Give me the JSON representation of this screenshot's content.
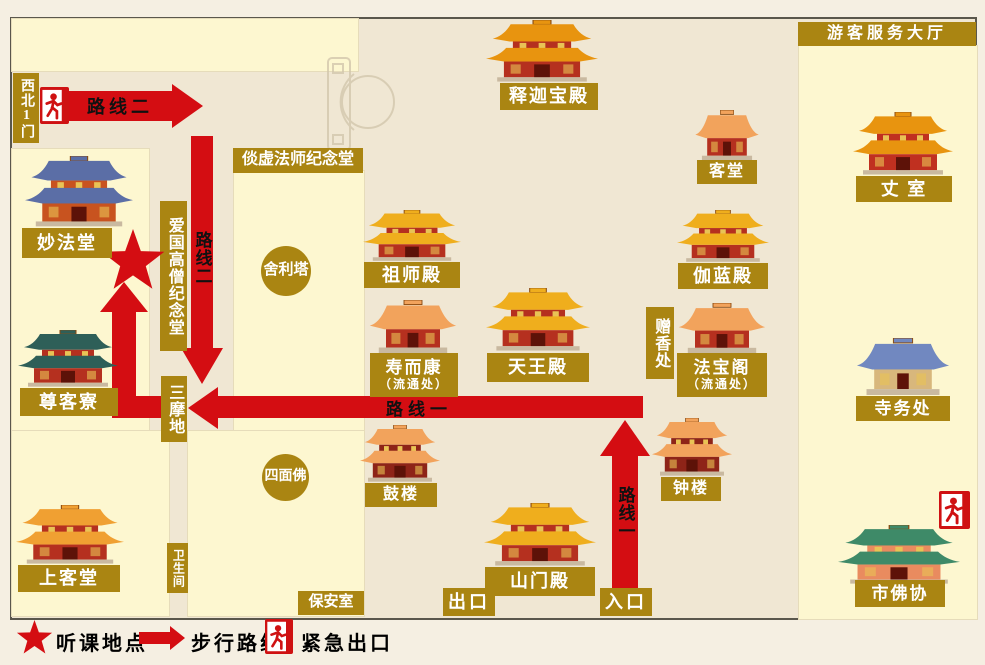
{
  "banner": {
    "visitor_hall": "游客服务大厅"
  },
  "routes": {
    "route1": "路线一",
    "route2": "路线二"
  },
  "areas": {
    "northwest_gate": "西北1门",
    "tanxu_memorial": "倓虚法师纪念堂",
    "patriotic_monk_memorial": "爱国高僧纪念堂",
    "samadhi": "三摩地",
    "sarira_pagoda": "舍利塔",
    "four_faced_buddha": "四面佛",
    "incense_offering": "赠香处",
    "restroom": "卫生间",
    "security_room": "保安室",
    "exit": "出口",
    "entrance": "入口"
  },
  "buildings": [
    {
      "id": "shijiabaodian",
      "label": "释迦宝殿",
      "roof": "#e8940f",
      "body": "#b5301f",
      "tiers": 2
    },
    {
      "id": "ketang",
      "label": "客堂",
      "roof": "#f2a35c",
      "body": "#b5301f",
      "tiers": 1
    },
    {
      "id": "zhangshi",
      "label": "丈 室",
      "roof": "#e8940f",
      "body": "#c03020",
      "tiers": 2
    },
    {
      "id": "miaofatang",
      "label": "妙法堂",
      "roof": "#5b6ea6",
      "body": "#c8531f",
      "tiers": 2
    },
    {
      "id": "zushidian",
      "label": "祖师殿",
      "roof": "#efae1d",
      "body": "#b5301f",
      "tiers": 2
    },
    {
      "id": "qielandian",
      "label": "伽蓝殿",
      "roof": "#efae1d",
      "body": "#b5301f",
      "tiers": 2
    },
    {
      "id": "shouerkang",
      "label": "寿而康",
      "sublabel": "（流通处）",
      "roof": "#f2a35c",
      "body": "#b5301f",
      "tiers": 1
    },
    {
      "id": "tianwangdian",
      "label": "天王殿",
      "roof": "#efae1d",
      "body": "#b5301f",
      "tiers": 2
    },
    {
      "id": "fabaoge",
      "label": "法宝阁",
      "sublabel": "（流通处）",
      "roof": "#f2a35c",
      "body": "#b5301f",
      "tiers": 1
    },
    {
      "id": "siwuchu",
      "label": "寺务处",
      "roof": "#7188c0",
      "body": "#d8b77c",
      "tiers": 1
    },
    {
      "id": "zunkeliao",
      "label": "尊客寮",
      "roof": "#2e5f58",
      "body": "#b5301f",
      "tiers": 2
    },
    {
      "id": "gulou",
      "label": "鼓楼",
      "roof": "#f2a35c",
      "body": "#8e2418",
      "tiers": 2
    },
    {
      "id": "zhonglou",
      "label": "钟楼",
      "roof": "#f2a35c",
      "body": "#8e2418",
      "tiers": 2
    },
    {
      "id": "shanmendian",
      "label": "山门殿",
      "roof": "#efae1d",
      "body": "#b5301f",
      "tiers": 2
    },
    {
      "id": "shangketang",
      "label": "上客堂",
      "roof": "#f0a032",
      "body": "#b5301f",
      "tiers": 2
    },
    {
      "id": "shifoxie",
      "label": "市佛协",
      "roof": "#3e8a68",
      "body": "#e98b5f",
      "tiers": 2
    }
  ],
  "legend": {
    "items": [
      {
        "icon": "star-icon",
        "label": "听课地点"
      },
      {
        "icon": "walk-arrow-icon",
        "label": "步行路线"
      },
      {
        "icon": "emergency-exit-icon",
        "label": "紧急出口"
      }
    ]
  },
  "colors": {
    "route_red": "#d40d12",
    "label_gold": "#aa8512",
    "panel_yellow": "#fdf7d0",
    "map_beige": "#f0e7d3"
  }
}
